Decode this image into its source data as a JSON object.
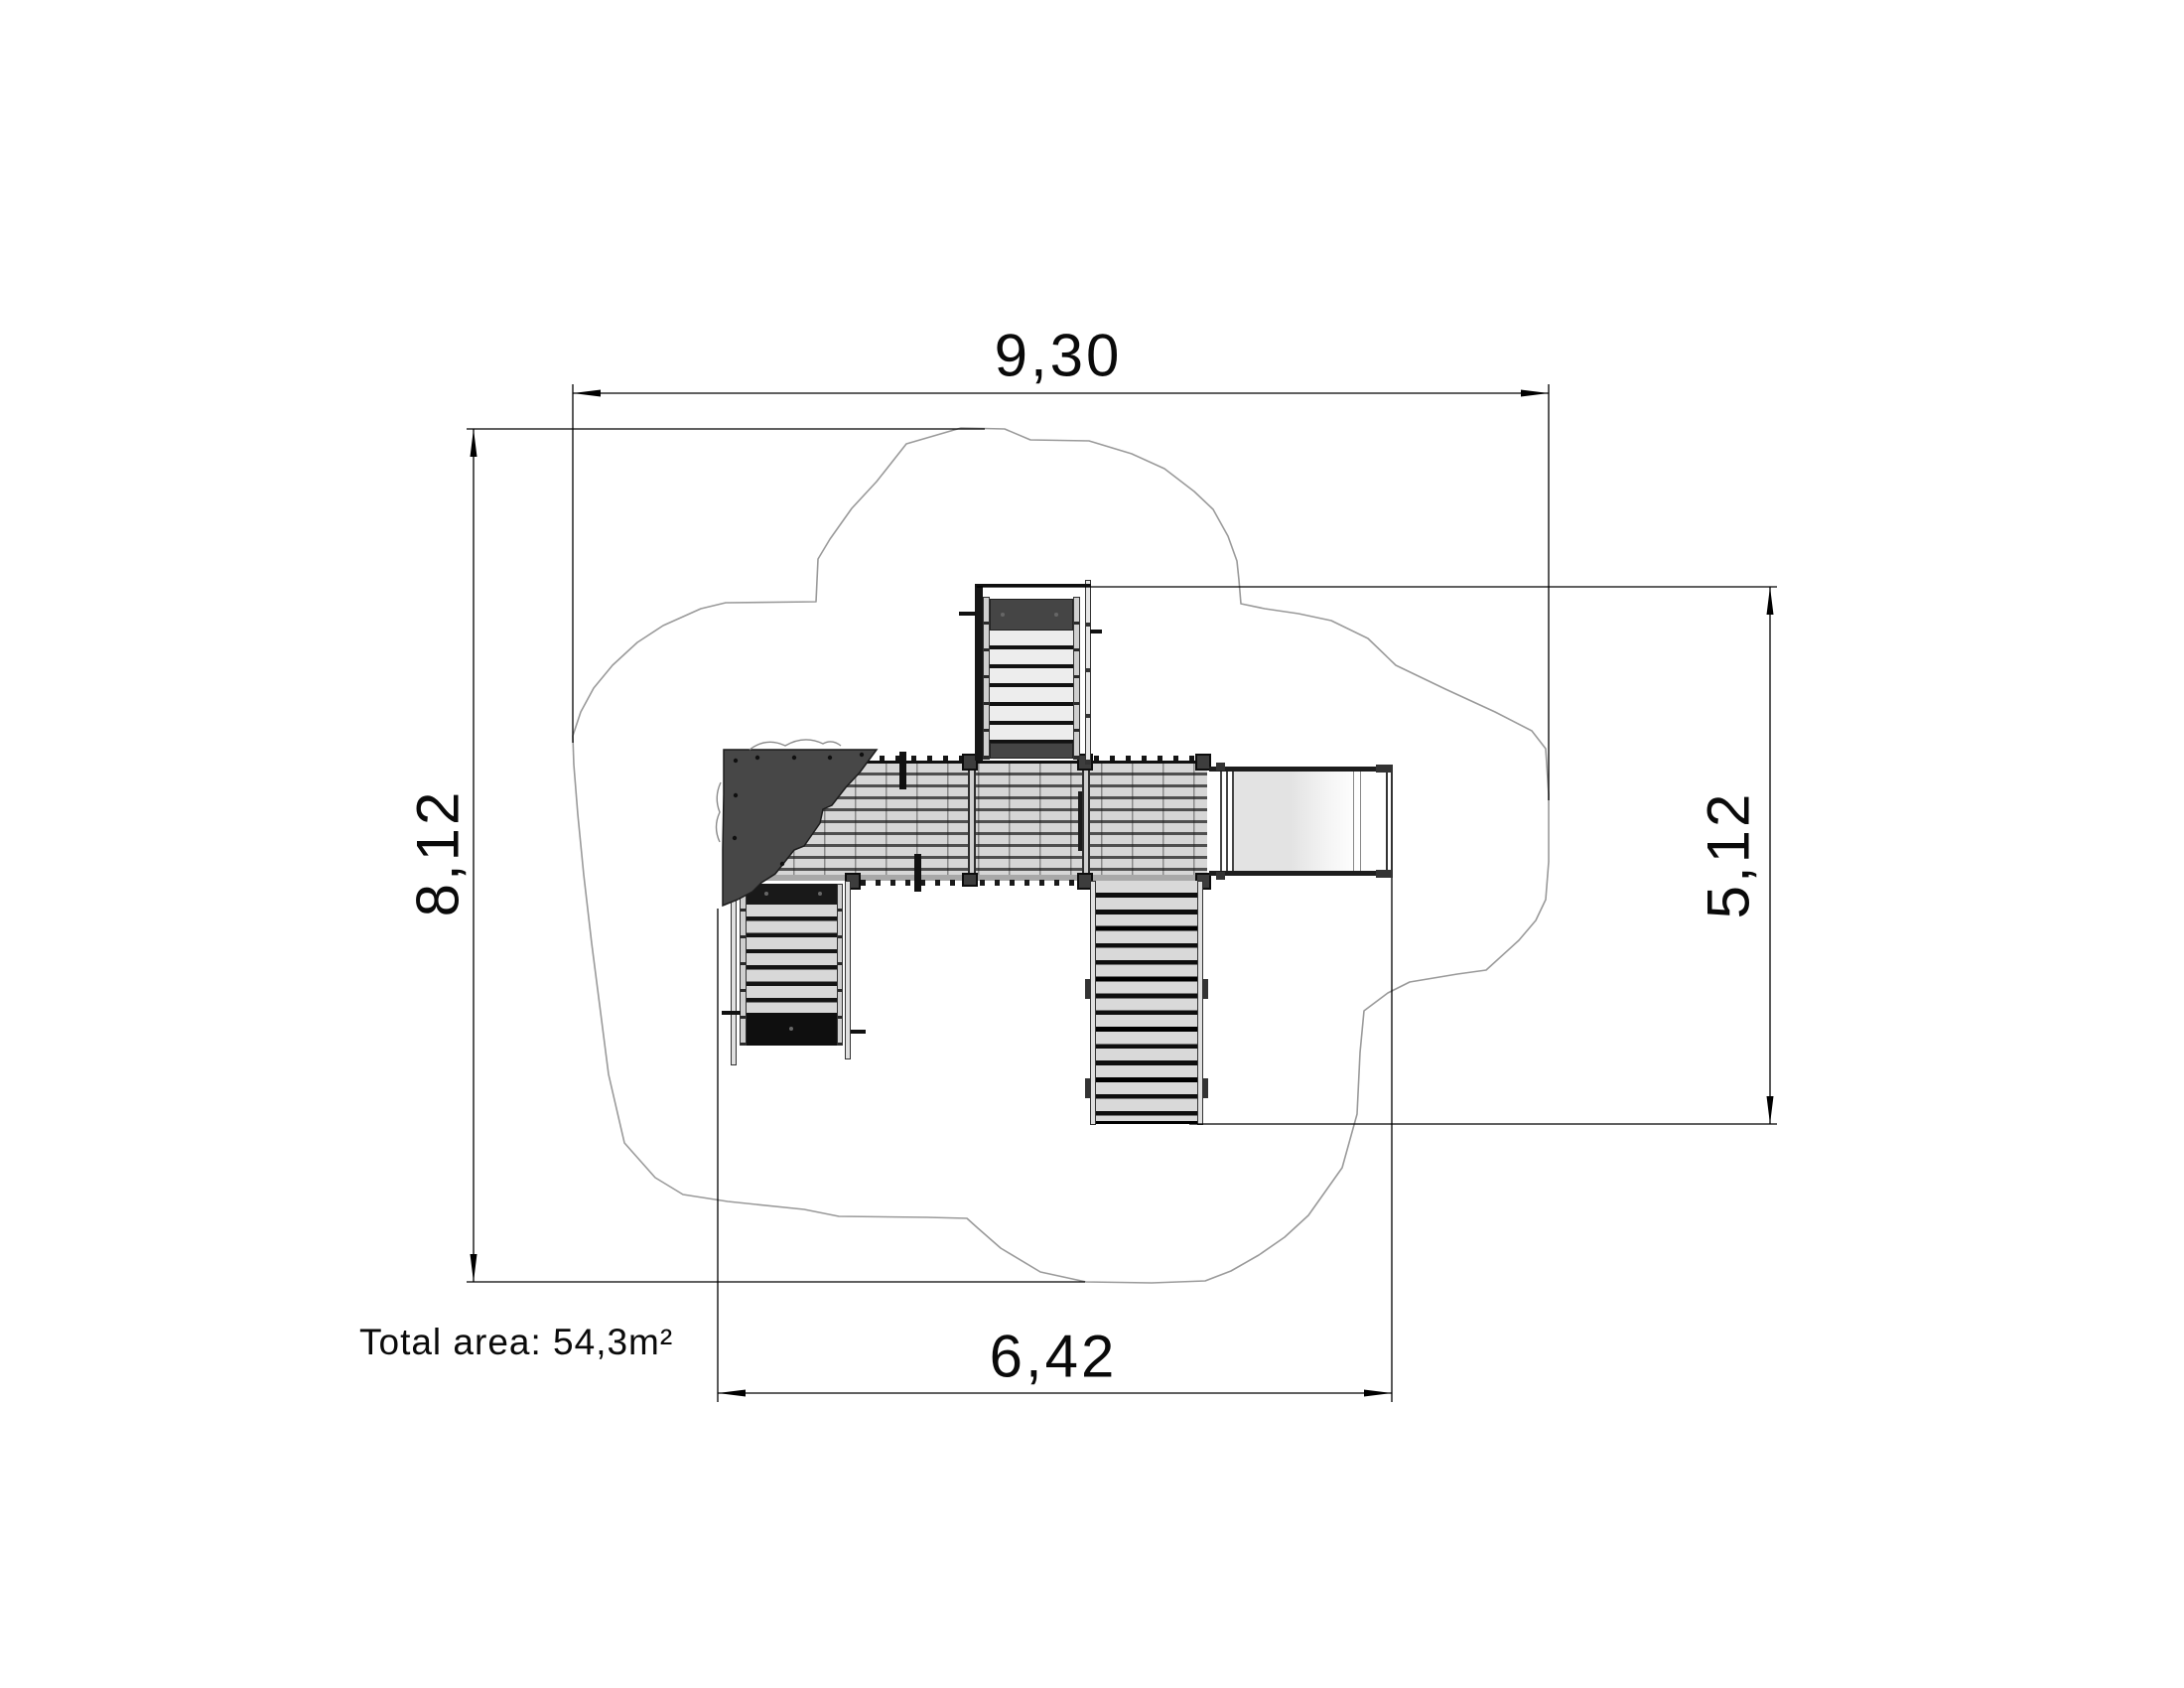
{
  "dimensions": {
    "total_width": {
      "value": "9,30"
    },
    "total_depth": {
      "value": "8,12"
    },
    "structure_depth": {
      "value": "5,12"
    },
    "structure_width": {
      "value": "6,42"
    }
  },
  "annotations": {
    "total_area": "Total area: 54,3m²"
  },
  "colors": {
    "line": "#000000",
    "safety_area_outline": "#9a9a9a",
    "roof_fill": "#474747",
    "deck_slat": "#d6d6d6",
    "dark_panel": "#1a1a1a",
    "background": "#ffffff"
  }
}
